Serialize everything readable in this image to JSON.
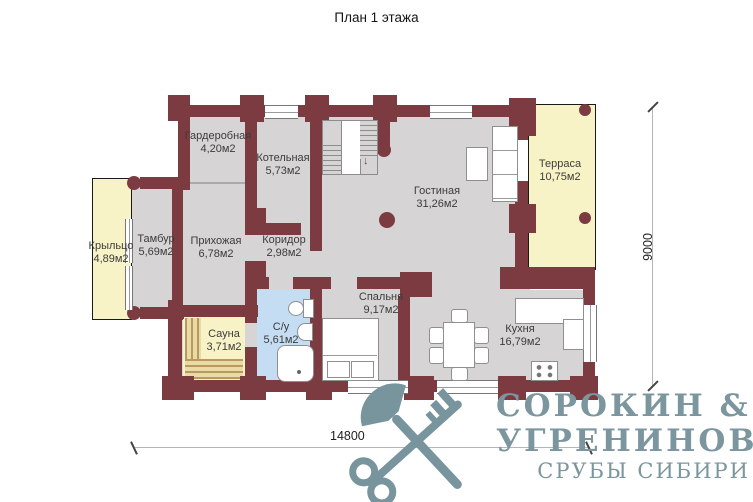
{
  "title": "План 1 этажа",
  "rooms": [
    {
      "id": "wardrobe",
      "name": "Гардеробная",
      "area": "4,20м2"
    },
    {
      "id": "boiler",
      "name": "Котельная",
      "area": "5,73м2"
    },
    {
      "id": "living",
      "name": "Гостиная",
      "area": "31,26м2"
    },
    {
      "id": "terrace",
      "name": "Терраса",
      "area": "10,75м2"
    },
    {
      "id": "porch",
      "name": "Крыльцо",
      "area": "4,89м2"
    },
    {
      "id": "tambour",
      "name": "Тамбур",
      "area": "5,69м2"
    },
    {
      "id": "hallway",
      "name": "Прихожая",
      "area": "6,78м2"
    },
    {
      "id": "corridor",
      "name": "Коридор",
      "area": "2,98м2"
    },
    {
      "id": "sauna",
      "name": "Сауна",
      "area": "3,71м2"
    },
    {
      "id": "bathroom",
      "name": "С/у",
      "area": "5,61м2"
    },
    {
      "id": "bedroom",
      "name": "Спальня",
      "area": "9,17м2"
    },
    {
      "id": "kitchen",
      "name": "Кухня",
      "area": "16,79м2"
    }
  ],
  "dimensions": {
    "width_label": "14800",
    "height_label": "9000"
  },
  "logo": {
    "line1": "СОРОКИН &",
    "line2": "УГРЕНИНОВ",
    "line3": "СРУБЫ СИБИРИ",
    "icon": "axe-key-icon"
  },
  "colors": {
    "wall": "#7b3b40",
    "floor": "#d6d4d5",
    "accent_yellow": "#f8f3c6",
    "bathroom_blue": "#c5ddf2",
    "logo_teal": "#7b969e"
  }
}
